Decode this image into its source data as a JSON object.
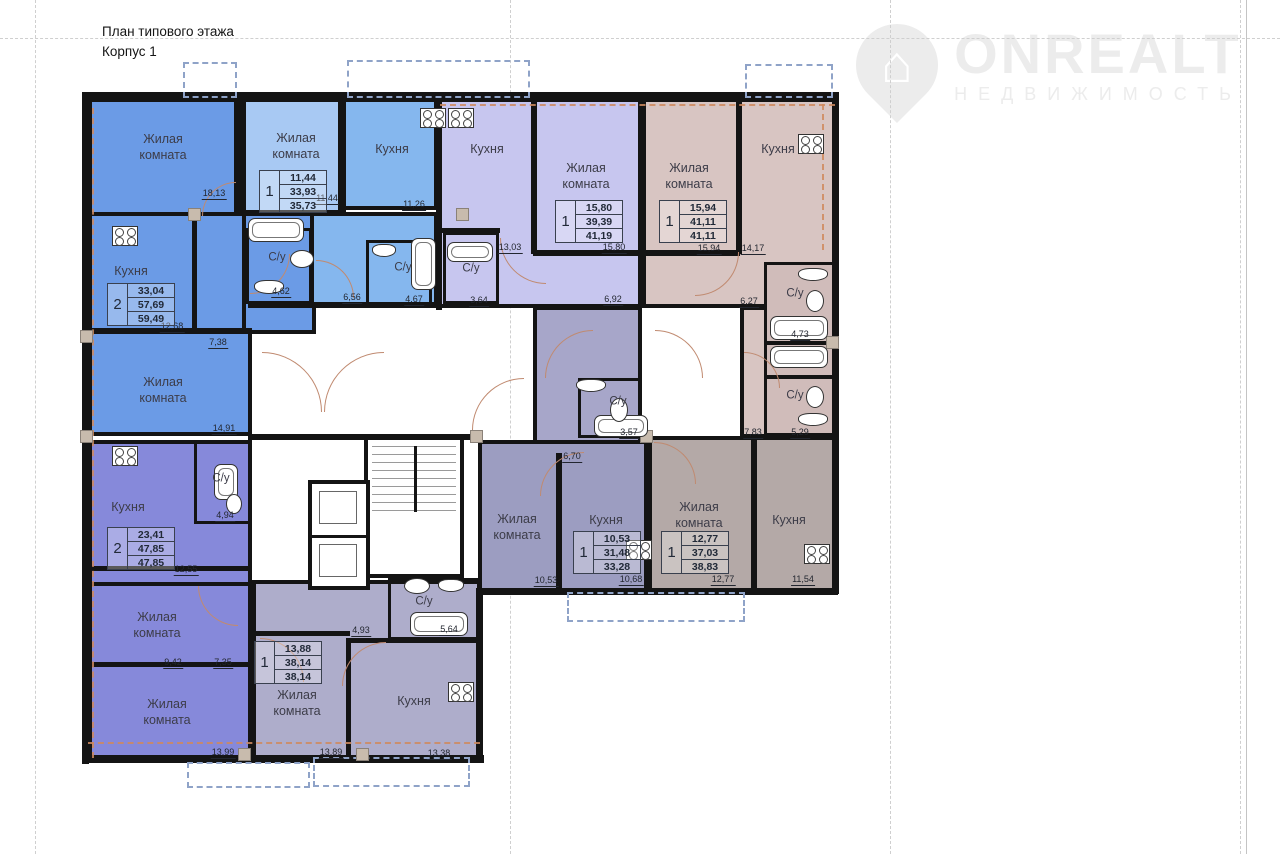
{
  "title": {
    "line1": "План типового этажа",
    "line2": "Корпус 1"
  },
  "logo": {
    "brand": "ONREALT",
    "subtitle": "НЕДВИЖИМОСТЬ",
    "house_icon": "⌂"
  },
  "colors": {
    "wall": "#141414",
    "blue": "#6b9be6",
    "lblue": "#a8c9f3",
    "mblue": "#85b7ee",
    "lav": "#c7c6ef",
    "rose": "#d8c5c2",
    "rose2": "#d0bcba",
    "peri": "#8689da",
    "glav": "#aeadcb",
    "glav2": "#a7a6c9",
    "gper": "#9c9dc1",
    "gbeige": "#b4a9a7",
    "arc": "#c08a70",
    "axis": "#cf8a5e",
    "balcony": "#8fa3c8",
    "grid": "#cfcfcf"
  },
  "blocks": [
    {
      "x": 88,
      "y": 98,
      "w": 150,
      "h": 120,
      "c": "blue"
    },
    {
      "x": 88,
      "y": 212,
      "w": 164,
      "h": 224,
      "c": "blue"
    },
    {
      "x": 242,
      "y": 212,
      "w": 74,
      "h": 122,
      "c": "blue"
    },
    {
      "x": 242,
      "y": 98,
      "w": 104,
      "h": 116,
      "c": "lblue"
    },
    {
      "x": 342,
      "y": 98,
      "w": 96,
      "h": 112,
      "c": "mblue"
    },
    {
      "x": 310,
      "y": 212,
      "w": 128,
      "h": 96,
      "c": "mblue"
    },
    {
      "x": 438,
      "y": 98,
      "w": 204,
      "h": 210,
      "c": "lav"
    },
    {
      "x": 642,
      "y": 98,
      "w": 194,
      "h": 210,
      "c": "rose"
    },
    {
      "x": 740,
      "y": 306,
      "w": 96,
      "h": 132,
      "c": "rose"
    },
    {
      "x": 533,
      "y": 306,
      "w": 109,
      "h": 152,
      "c": "glav2"
    },
    {
      "x": 478,
      "y": 440,
      "w": 170,
      "h": 152,
      "c": "gper"
    },
    {
      "x": 648,
      "y": 436,
      "w": 188,
      "h": 156,
      "c": "gbeige"
    },
    {
      "x": 88,
      "y": 440,
      "w": 164,
      "h": 322,
      "c": "peri"
    },
    {
      "x": 252,
      "y": 580,
      "w": 230,
      "h": 182,
      "c": "glav"
    }
  ],
  "subrooms": [
    {
      "x": 246,
      "y": 228,
      "w": 66,
      "h": 76
    },
    {
      "x": 366,
      "y": 240,
      "w": 66,
      "h": 66
    },
    {
      "x": 443,
      "y": 232,
      "w": 56,
      "h": 72
    },
    {
      "x": 764,
      "y": 262,
      "w": 72,
      "h": 82,
      "c": "rose2"
    },
    {
      "x": 764,
      "y": 342,
      "w": 72,
      "h": 36,
      "c": "rose2"
    },
    {
      "x": 764,
      "y": 376,
      "w": 72,
      "h": 60,
      "c": "rose2"
    },
    {
      "x": 578,
      "y": 378,
      "w": 64,
      "h": 60
    },
    {
      "x": 388,
      "y": 578,
      "w": 92,
      "h": 62
    },
    {
      "x": 194,
      "y": 440,
      "w": 58,
      "h": 84
    }
  ],
  "walls": [
    [
      83,
      92,
      756,
      7
    ],
    [
      82,
      92,
      7,
      672
    ],
    [
      832,
      92,
      7,
      502
    ],
    [
      476,
      588,
      362,
      7
    ],
    [
      476,
      588,
      7,
      175
    ],
    [
      82,
      755,
      402,
      8
    ],
    [
      236,
      98,
      8,
      118
    ],
    [
      338,
      98,
      6,
      114
    ],
    [
      436,
      98,
      6,
      212
    ],
    [
      640,
      98,
      6,
      210
    ],
    [
      736,
      98,
      6,
      156
    ],
    [
      531,
      98,
      6,
      156
    ],
    [
      192,
      212,
      5,
      120
    ],
    [
      88,
      328,
      164,
      6
    ],
    [
      438,
      228,
      62,
      5
    ],
    [
      533,
      250,
      109,
      6
    ],
    [
      642,
      250,
      98,
      6
    ],
    [
      248,
      302,
      192,
      6
    ],
    [
      248,
      434,
      234,
      6
    ],
    [
      556,
      453,
      6,
      139
    ],
    [
      751,
      436,
      6,
      156
    ],
    [
      88,
      566,
      164,
      5
    ],
    [
      88,
      582,
      164,
      4
    ],
    [
      88,
      662,
      164,
      5
    ],
    [
      346,
      638,
      5,
      124
    ],
    [
      252,
      631,
      98,
      5
    ],
    [
      348,
      638,
      134,
      5
    ]
  ],
  "labels": [
    {
      "t": "Жилая\nкомната",
      "x": 163,
      "y": 147
    },
    {
      "t": "Жилая\nкомната",
      "x": 296,
      "y": 146
    },
    {
      "t": "Кухня",
      "x": 392,
      "y": 149
    },
    {
      "t": "Кухня",
      "x": 487,
      "y": 149
    },
    {
      "t": "Жилая\nкомната",
      "x": 586,
      "y": 176
    },
    {
      "t": "Жилая\nкомната",
      "x": 689,
      "y": 176
    },
    {
      "t": "Кухня",
      "x": 778,
      "y": 149
    },
    {
      "t": "Кухня",
      "x": 131,
      "y": 271
    },
    {
      "t": "Жилая\nкомната",
      "x": 163,
      "y": 390
    },
    {
      "t": "Кухня",
      "x": 128,
      "y": 507
    },
    {
      "t": "Жилая\nкомната",
      "x": 157,
      "y": 625
    },
    {
      "t": "Жилая\nкомната",
      "x": 167,
      "y": 712
    },
    {
      "t": "Жилая\nкомната",
      "x": 297,
      "y": 703
    },
    {
      "t": "Кухня",
      "x": 414,
      "y": 701
    },
    {
      "t": "Жилая\nкомната",
      "x": 517,
      "y": 527
    },
    {
      "t": "Кухня",
      "x": 606,
      "y": 520
    },
    {
      "t": "Жилая\nкомната",
      "x": 699,
      "y": 515
    },
    {
      "t": "Кухня",
      "x": 789,
      "y": 520
    },
    {
      "t": "С/у",
      "x": 277,
      "y": 258,
      "s": 1
    },
    {
      "t": "С/у",
      "x": 403,
      "y": 268,
      "s": 1
    },
    {
      "t": "С/у",
      "x": 471,
      "y": 269,
      "s": 1
    },
    {
      "t": "С/у",
      "x": 795,
      "y": 294,
      "s": 1
    },
    {
      "t": "С/у",
      "x": 795,
      "y": 396,
      "s": 1
    },
    {
      "t": "С/у",
      "x": 618,
      "y": 402,
      "s": 1
    },
    {
      "t": "С/у",
      "x": 424,
      "y": 602,
      "s": 1
    },
    {
      "t": "С/у",
      "x": 221,
      "y": 479,
      "s": 1
    }
  ],
  "dims": [
    {
      "v": "18,13",
      "x": 214,
      "y": 189
    },
    {
      "v": "11,44",
      "x": 327,
      "y": 194
    },
    {
      "v": "11,26",
      "x": 414,
      "y": 200
    },
    {
      "v": "13,03",
      "x": 510,
      "y": 243
    },
    {
      "v": "15,80",
      "x": 614,
      "y": 243
    },
    {
      "v": "6,92",
      "x": 613,
      "y": 295
    },
    {
      "v": "15,94",
      "x": 709,
      "y": 244
    },
    {
      "v": "14,17",
      "x": 753,
      "y": 244
    },
    {
      "v": "12,68",
      "x": 172,
      "y": 322
    },
    {
      "v": "4,62",
      "x": 281,
      "y": 287
    },
    {
      "v": "6,56",
      "x": 352,
      "y": 293
    },
    {
      "v": "4,67",
      "x": 414,
      "y": 295
    },
    {
      "v": "3,64",
      "x": 479,
      "y": 296
    },
    {
      "v": "6,27",
      "x": 749,
      "y": 297
    },
    {
      "v": "4,73",
      "x": 800,
      "y": 330
    },
    {
      "v": "7,38",
      "x": 218,
      "y": 338
    },
    {
      "v": "14,91",
      "x": 224,
      "y": 424
    },
    {
      "v": "3,57",
      "x": 629,
      "y": 428
    },
    {
      "v": "6,70",
      "x": 572,
      "y": 452
    },
    {
      "v": "7,83",
      "x": 753,
      "y": 428
    },
    {
      "v": "5,29",
      "x": 800,
      "y": 428
    },
    {
      "v": "4,94",
      "x": 225,
      "y": 511
    },
    {
      "v": "12,55",
      "x": 186,
      "y": 565
    },
    {
      "v": "4,93",
      "x": 361,
      "y": 626
    },
    {
      "v": "5,64",
      "x": 449,
      "y": 625
    },
    {
      "v": "10,53",
      "x": 546,
      "y": 576
    },
    {
      "v": "10,68",
      "x": 631,
      "y": 575
    },
    {
      "v": "12,77",
      "x": 723,
      "y": 575
    },
    {
      "v": "11,54",
      "x": 803,
      "y": 575
    },
    {
      "v": "9,42",
      "x": 173,
      "y": 658
    },
    {
      "v": "7,35",
      "x": 223,
      "y": 658
    },
    {
      "v": "13,99",
      "x": 223,
      "y": 748
    },
    {
      "v": "13,89",
      "x": 331,
      "y": 748
    },
    {
      "v": "13,38",
      "x": 439,
      "y": 749
    }
  ],
  "stamps": [
    {
      "n": "2",
      "v": [
        "33,04",
        "57,69",
        "59,49"
      ],
      "x": 107,
      "y": 283
    },
    {
      "n": "1",
      "v": [
        "11,44",
        "33,93",
        "35,73"
      ],
      "x": 259,
      "y": 170
    },
    {
      "n": "1",
      "v": [
        "15,80",
        "39,39",
        "41,19"
      ],
      "x": 555,
      "y": 200
    },
    {
      "n": "1",
      "v": [
        "15,94",
        "41,11",
        "41,11"
      ],
      "x": 659,
      "y": 200
    },
    {
      "n": "2",
      "v": [
        "23,41",
        "47,85",
        "47,85"
      ],
      "x": 107,
      "y": 527
    },
    {
      "n": "1",
      "v": [
        "10,53",
        "31,48",
        "33,28"
      ],
      "x": 573,
      "y": 531
    },
    {
      "n": "1",
      "v": [
        "12,77",
        "37,03",
        "38,83"
      ],
      "x": 661,
      "y": 531
    },
    {
      "n": "1",
      "v": [
        "13,88",
        "38,14",
        "38,14"
      ],
      "x": 254,
      "y": 641
    }
  ],
  "fixtures": {
    "stoves": [
      [
        112,
        226
      ],
      [
        420,
        108
      ],
      [
        448,
        108
      ],
      [
        798,
        134
      ],
      [
        626,
        540
      ],
      [
        804,
        544
      ],
      [
        448,
        682
      ],
      [
        112,
        446
      ]
    ],
    "baths": [
      [
        248,
        218,
        56,
        24
      ],
      [
        411,
        238,
        25,
        52
      ],
      [
        447,
        242,
        46,
        20
      ],
      [
        594,
        415,
        54,
        22
      ],
      [
        770,
        316,
        58,
        24
      ],
      [
        770,
        346,
        58,
        22
      ],
      [
        410,
        612,
        58,
        24
      ],
      [
        214,
        464,
        24,
        36
      ]
    ],
    "sinks": [
      [
        290,
        250,
        24,
        18
      ],
      [
        610,
        398,
        18,
        24
      ],
      [
        806,
        290,
        18,
        22
      ],
      [
        806,
        386,
        18,
        22
      ],
      [
        226,
        494,
        16,
        20
      ],
      [
        404,
        578,
        26,
        16
      ]
    ],
    "wcs": [
      [
        254,
        280,
        30,
        14
      ],
      [
        372,
        244,
        24,
        13
      ],
      [
        576,
        379,
        30,
        13
      ],
      [
        798,
        268,
        30,
        13
      ],
      [
        798,
        413,
        30,
        13
      ],
      [
        438,
        579,
        26,
        13
      ]
    ]
  },
  "arcs": [
    {
      "x": 202,
      "y": 182,
      "r": 34,
      "q": "tl"
    },
    {
      "x": 250,
      "y": 254,
      "r": 40,
      "q": "br"
    },
    {
      "x": 316,
      "y": 260,
      "r": 38,
      "q": "tr"
    },
    {
      "x": 500,
      "y": 238,
      "r": 46,
      "q": "bl"
    },
    {
      "x": 545,
      "y": 330,
      "r": 48,
      "q": "tl"
    },
    {
      "x": 655,
      "y": 330,
      "r": 48,
      "q": "tr"
    },
    {
      "x": 695,
      "y": 252,
      "r": 44,
      "q": "br"
    },
    {
      "x": 262,
      "y": 352,
      "r": 60,
      "q": "tr"
    },
    {
      "x": 324,
      "y": 352,
      "r": 60,
      "q": "tl"
    },
    {
      "x": 472,
      "y": 378,
      "r": 52,
      "q": "tl"
    },
    {
      "x": 540,
      "y": 452,
      "r": 44,
      "q": "tl"
    },
    {
      "x": 654,
      "y": 442,
      "r": 42,
      "q": "tr"
    },
    {
      "x": 198,
      "y": 586,
      "r": 40,
      "q": "bl"
    },
    {
      "x": 260,
      "y": 638,
      "r": 44,
      "q": "tr"
    },
    {
      "x": 744,
      "y": 352,
      "r": 36,
      "q": "tr"
    },
    {
      "x": 342,
      "y": 642,
      "r": 44,
      "q": "tl"
    }
  ],
  "balconies": [
    [
      183,
      62,
      54,
      36
    ],
    [
      347,
      60,
      183,
      38
    ],
    [
      745,
      64,
      88,
      34
    ],
    [
      187,
      762,
      123,
      26
    ],
    [
      313,
      757,
      157,
      30
    ],
    [
      567,
      592,
      178,
      30
    ]
  ],
  "axes": [
    {
      "o": "h",
      "x": 440,
      "y": 104,
      "len": 395
    },
    {
      "o": "h",
      "x": 88,
      "y": 742,
      "len": 392
    },
    {
      "o": "v",
      "x": 822,
      "y": 104,
      "len": 146
    },
    {
      "o": "v",
      "x": 92,
      "y": 108,
      "len": 650
    }
  ],
  "grid": {
    "v": [
      35,
      510,
      890,
      1240
    ],
    "h": [
      38
    ]
  },
  "anchors": [
    [
      80,
      330
    ],
    [
      80,
      430
    ],
    [
      188,
      208
    ],
    [
      470,
      430
    ],
    [
      640,
      430
    ],
    [
      826,
      336
    ],
    [
      238,
      748
    ],
    [
      356,
      748
    ],
    [
      456,
      208
    ]
  ],
  "stair": {
    "x": 364,
    "y": 436,
    "w": 100,
    "h": 142
  },
  "elevator": {
    "x": 308,
    "y": 480,
    "w": 62,
    "h": 110
  }
}
